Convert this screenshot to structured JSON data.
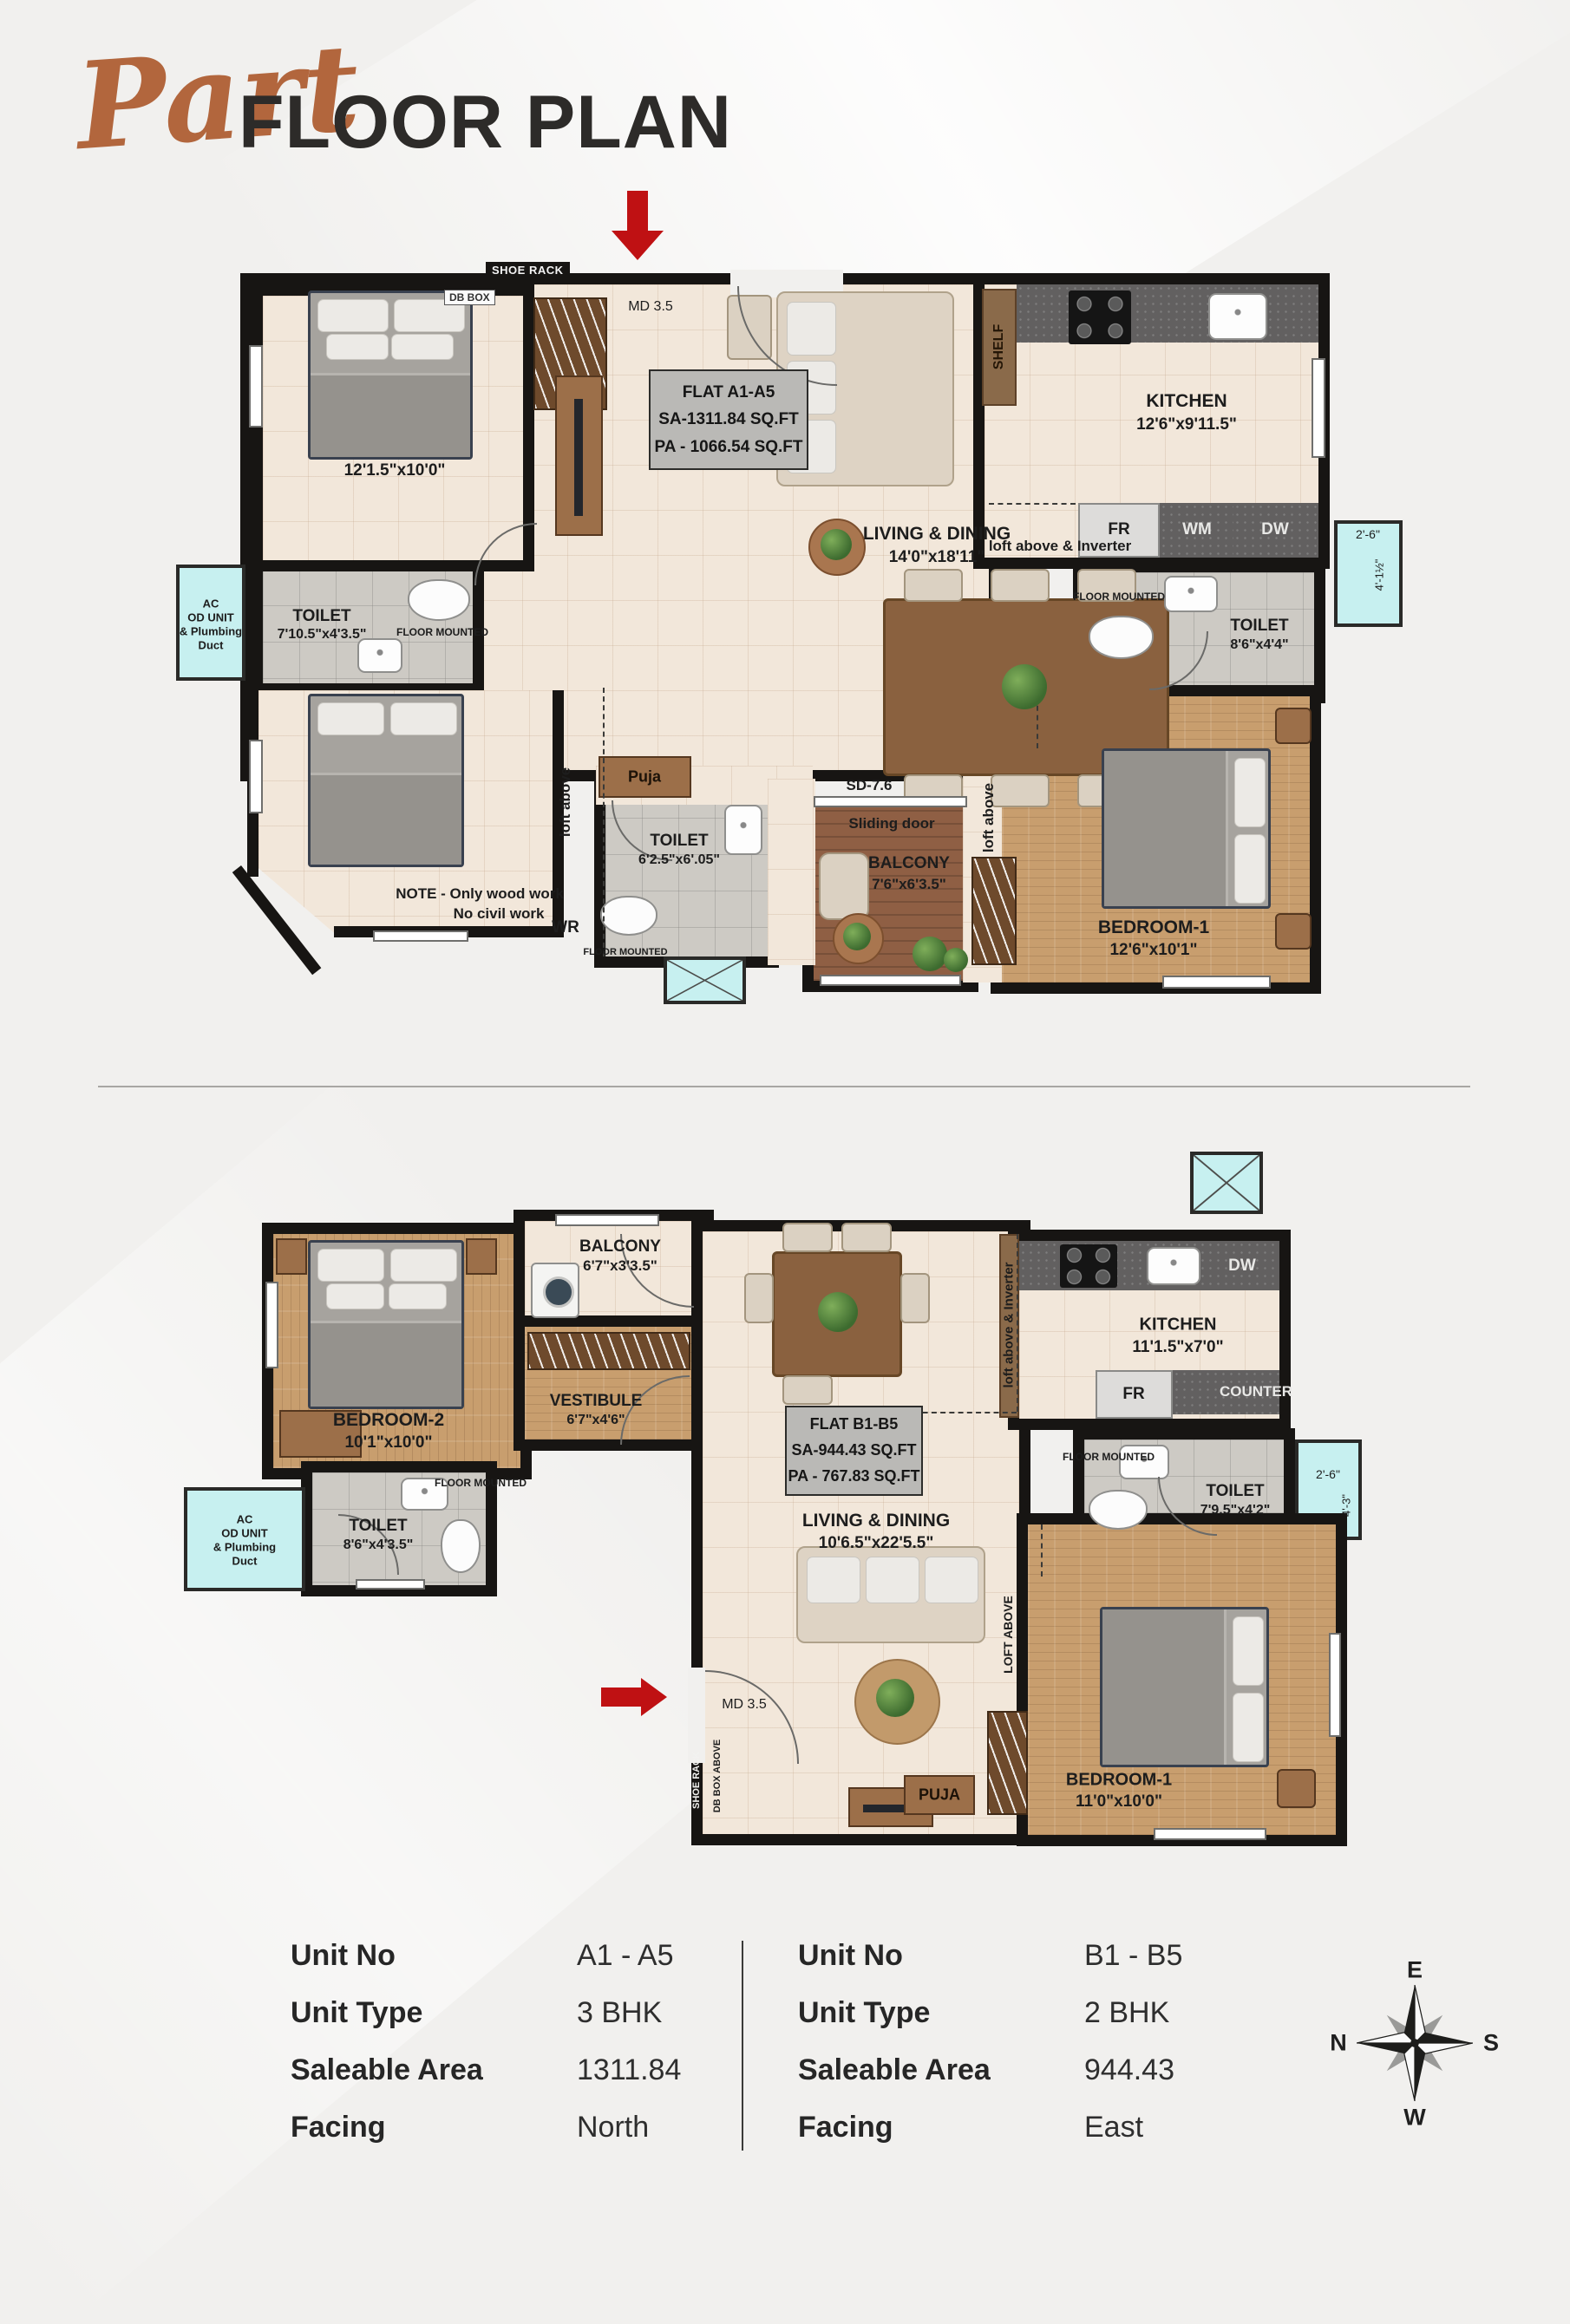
{
  "title": {
    "script": "Part",
    "main": "FLOOR PLAN"
  },
  "plan_a": {
    "flat_box": {
      "l1": "FLAT A1-A5",
      "l2": "SA-1311.84 SQ.FT",
      "l3": "PA - 1066.54 SQ.FT"
    },
    "shoe_rack": "SHOE RACK",
    "db_box": "DB BOX",
    "main_door": "MD 3.5",
    "bedroom_tl_dims": "12'1.5\"x10'0\"",
    "kitchen": {
      "name": "KITCHEN",
      "dims": "12'6\"x9'11.5\""
    },
    "shelf": "SHELF",
    "living": {
      "name": "LIVING & DINING",
      "dims": "14'0\"x18'11\""
    },
    "loft_inverter": "loft above & Inverter",
    "fr": "FR",
    "wm": "WM",
    "dw": "DW",
    "floor_mounted": "FLOOR MOUNTED",
    "toilet_left": {
      "name": "TOILET",
      "dims": "7'10.5\"x4'3.5\""
    },
    "toilet_mid": {
      "name": "TOILET",
      "dims": "6'2.5\"x6'.05\""
    },
    "toilet_right": {
      "name": "TOILET",
      "dims": "8'6\"x4'4\""
    },
    "ac_duct": {
      "l1": "AC",
      "l2": "OD UNIT",
      "l3": "& Plumbing",
      "l4": "Duct"
    },
    "dim_right_w": "2'-6\"",
    "dim_right_h": "4'-1½\"",
    "note_l1": "NOTE - Only wood work",
    "note_l2": "No civil work",
    "puja": "Puja",
    "loft_above": "loft above",
    "wr": "WR",
    "sliding_door_tag": "SD-7.6",
    "sliding_door": "Sliding door",
    "balcony": {
      "name": "BALCONY",
      "dims": "7'6\"x6'3.5\""
    },
    "bedroom1": {
      "name": "BEDROOM-1",
      "dims": "12'6\"x10'1\""
    }
  },
  "plan_b": {
    "flat_box": {
      "l1": "FLAT B1-B5",
      "l2": "SA-944.43 SQ.FT",
      "l3": "PA - 767.83 SQ.FT"
    },
    "bedroom2": {
      "name": "BEDROOM-2",
      "dims": "10'1\"x10'0\""
    },
    "balcony": {
      "name": "BALCONY",
      "dims": "6'7\"x3'3.5\""
    },
    "vestibule": {
      "name": "VESTIBULE",
      "dims": "6'7\"x4'6\""
    },
    "ac_duct": {
      "l1": "AC",
      "l2": "OD UNIT",
      "l3": "& Plumbing",
      "l4": "Duct"
    },
    "toilet_left": {
      "name": "TOILET",
      "dims": "8'6\"x4'3.5\""
    },
    "toilet_right": {
      "name": "TOILET",
      "dims": "7'9.5\"x4'2\""
    },
    "floor_mounted": "FLOOR MOUNTED",
    "living": {
      "name": "LIVING & DINING",
      "dims": "10'6.5\"x22'5.5\""
    },
    "kitchen": {
      "name": "KITCHEN",
      "dims": "11'1.5\"x7'0\""
    },
    "fr": "FR",
    "dw": "DW",
    "counter": "COUNTER",
    "loft_inverter": "loft above & Inverter",
    "loft_above": "LOFT ABOVE",
    "dim_right_w": "2'-6\"",
    "dim_right_h": "4'-3\"",
    "main_door": "MD 3.5",
    "shoe_rack": "SHOE RACK",
    "db_box_above": "DB BOX ABOVE",
    "puja": "PUJA",
    "bedroom1": {
      "name": "BEDROOM-1",
      "dims": "11'0\"x10'0\""
    }
  },
  "units": {
    "left": {
      "unit_no_label": "Unit No",
      "unit_no": "A1 - A5",
      "unit_type_label": "Unit Type",
      "unit_type": "3 BHK",
      "area_label": "Saleable Area",
      "area": "1311.84",
      "facing_label": "Facing",
      "facing": "North"
    },
    "right": {
      "unit_no_label": "Unit No",
      "unit_no": "B1 - B5",
      "unit_type_label": "Unit Type",
      "unit_type": "2 BHK",
      "area_label": "Saleable Area",
      "area": "944.43",
      "facing_label": "Facing",
      "facing": "East"
    }
  },
  "compass": {
    "n": "N",
    "e": "E",
    "s": "S",
    "w": "W"
  }
}
